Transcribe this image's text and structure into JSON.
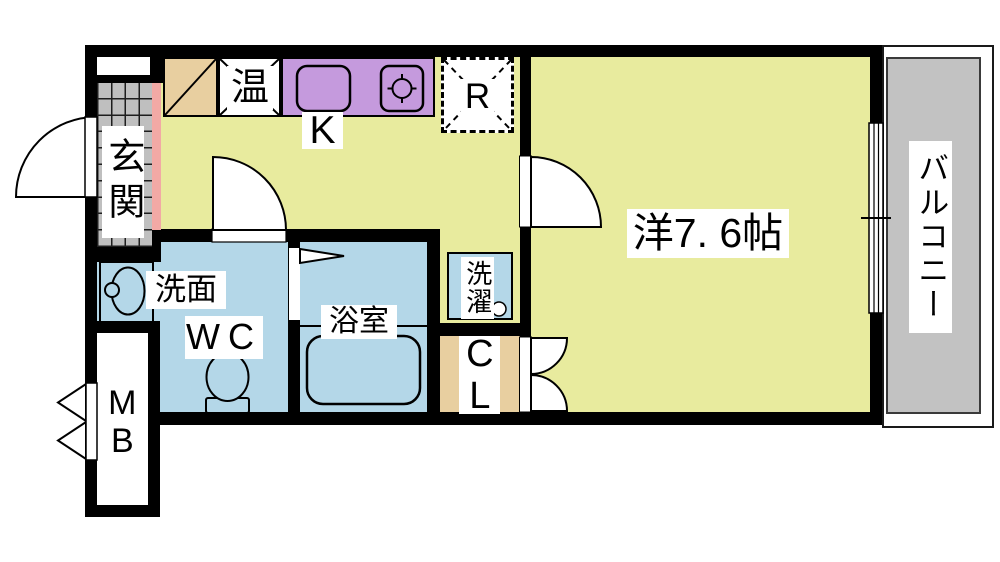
{
  "floorplan": {
    "title": "1K apartment floor plan",
    "rooms": {
      "entrance": {
        "label": "玄関"
      },
      "kitchen": {
        "label": "K"
      },
      "water_heater": {
        "label": "温"
      },
      "refrigerator_space": {
        "label": "R"
      },
      "western_room": {
        "label": "洋7. 6帖"
      },
      "balcony": {
        "label": "バルコニー"
      },
      "vanity": {
        "label": "洗面"
      },
      "toilet": {
        "label": "WC"
      },
      "bathroom": {
        "label": "浴室"
      },
      "laundry_space": {
        "label": "洗濯"
      },
      "closet": {
        "label": "CL"
      },
      "meter_box": {
        "label": "MB"
      }
    },
    "colors": {
      "wall": "#000000",
      "room_yellow": "#e8eb9e",
      "wet_area_blue": "#b4d7e8",
      "kitchen_counter_purple": "#c59add",
      "cabinet_tan": "#e8cfa0",
      "entrance_step_pink": "#f2a9a5",
      "balcony_gray": "#c2c2c2",
      "entrance_tile_gray": "#bfbfbf"
    }
  }
}
